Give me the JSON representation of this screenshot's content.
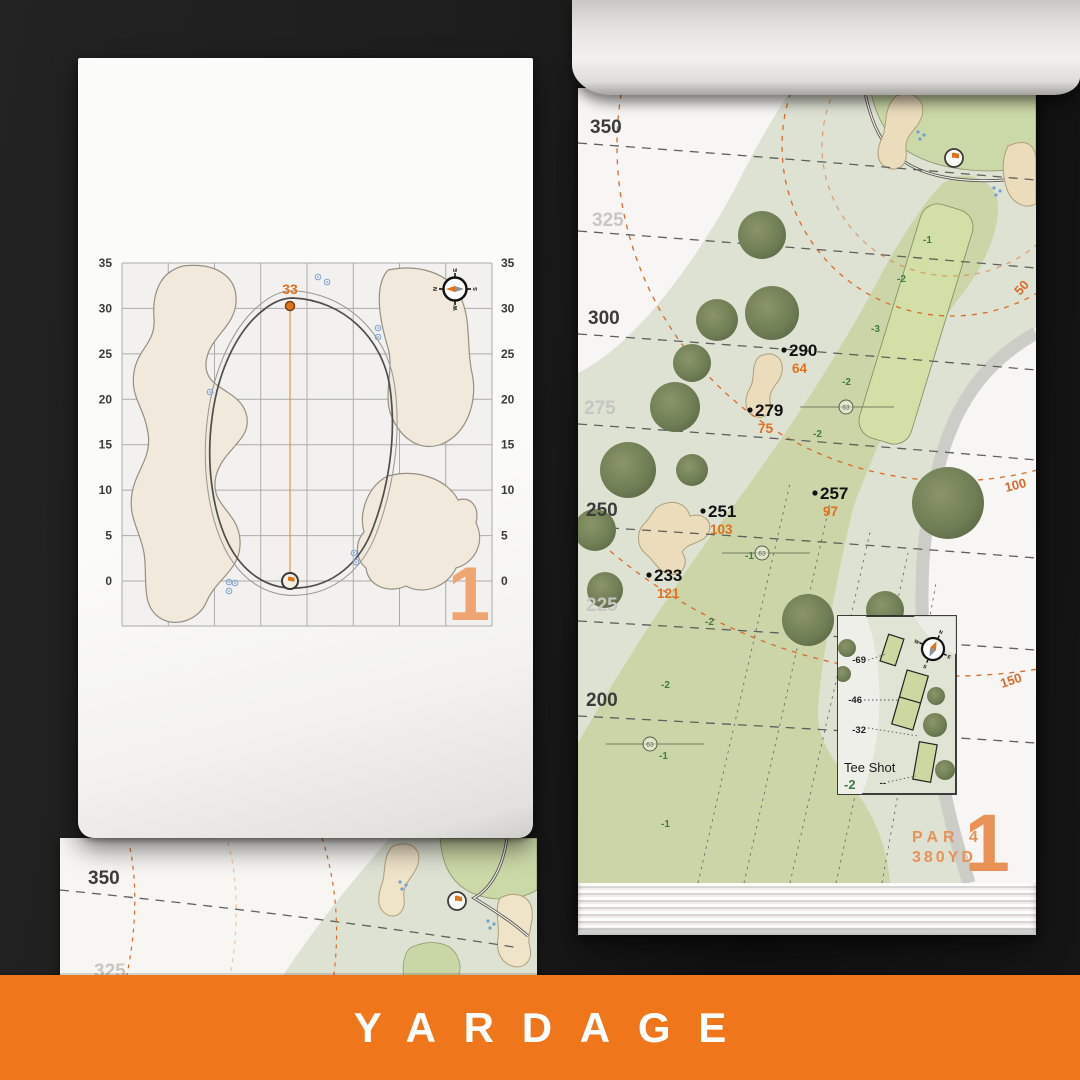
{
  "banner": {
    "label": "YARDAGE"
  },
  "colors": {
    "accent": "#F0761B",
    "accent-soft": "#E89258",
    "pin-orange": "#E2711D",
    "arc-orange": "#D96B2A",
    "sand": "#EBDCBC",
    "fairway": "#CBD5A8",
    "rough": "#DEE2D3",
    "tree": "#76825A",
    "elev-green": "#3F7B40",
    "band-strong": "#3C3C3A",
    "band-light": "#C6C6C2",
    "sprinkler-blue": "#6FA0D0"
  },
  "green_page": {
    "hole_number": "1",
    "pin_distance": "33",
    "ticks": [
      "35",
      "30",
      "25",
      "20",
      "15",
      "10",
      "5",
      "0"
    ],
    "compass": {
      "n": "N",
      "e": "E",
      "s": "S",
      "w": "W"
    }
  },
  "hole_page": {
    "hole_number": "1",
    "par": "PAR 4",
    "yards": "380YD",
    "bands": [
      {
        "label": "350"
      },
      {
        "label": "325"
      },
      {
        "label": "300"
      },
      {
        "label": "275"
      },
      {
        "label": "250"
      },
      {
        "label": "225"
      },
      {
        "label": "200"
      }
    ],
    "arcs": [
      {
        "label": "50"
      },
      {
        "label": "100"
      },
      {
        "label": "150"
      }
    ],
    "markers": [
      {
        "dist": "290",
        "remain": "64"
      },
      {
        "dist": "279",
        "remain": "75"
      },
      {
        "dist": "257",
        "remain": "97"
      },
      {
        "dist": "251",
        "remain": "103"
      },
      {
        "dist": "233",
        "remain": "121"
      }
    ],
    "sprinklers": [
      {
        "label": "63"
      },
      {
        "label": "63"
      },
      {
        "label": "63"
      }
    ],
    "elevations": [
      {
        "label": "-1"
      },
      {
        "label": "-2"
      },
      {
        "label": "-3"
      },
      {
        "label": "-2"
      },
      {
        "label": "-2"
      },
      {
        "label": "-1"
      },
      {
        "label": "-2"
      },
      {
        "label": "-2"
      },
      {
        "label": "-1"
      },
      {
        "label": "-1"
      }
    ],
    "tee_shot": {
      "title": "Tee Shot",
      "elevation": "-2",
      "tees": [
        {
          "label": "-69"
        },
        {
          "label": "-46"
        },
        {
          "label": "-32"
        },
        {
          "label": "--"
        }
      ]
    },
    "compass": {
      "n": "N",
      "e": "E",
      "s": "S",
      "w": "W"
    }
  },
  "under_page": {
    "bands": [
      {
        "label": "350"
      },
      {
        "label": "325"
      }
    ]
  }
}
